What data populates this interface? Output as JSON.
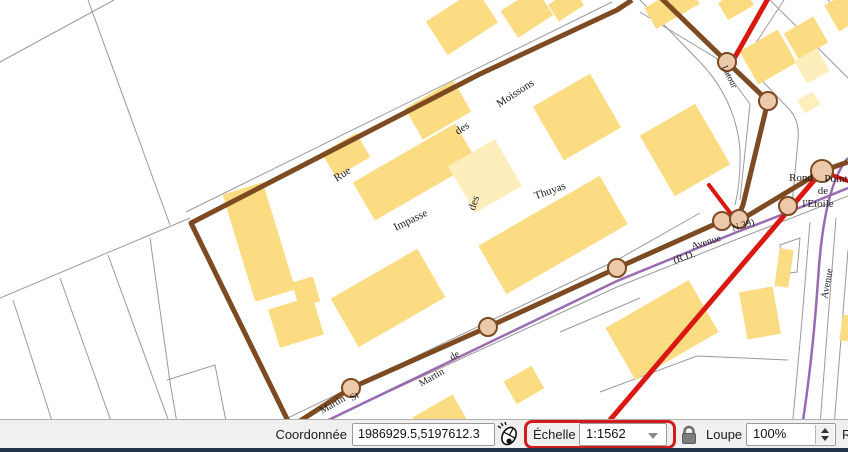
{
  "map": {
    "colors": {
      "background": "#ffffff",
      "building_fill": "#fbdc82",
      "building_light_fill": "#fdeebc",
      "parcel_line": "#9a9a9a",
      "route_brown": "#7d4a22",
      "node_fill": "#ecc9ab",
      "node_stroke": "#7d4a22",
      "road_purple": "#9a6bb0",
      "red_line": "#da1710",
      "label_color": "#1a1a1a"
    },
    "street_labels": [
      "Rue",
      "des",
      "Moissons",
      "Impasse",
      "des",
      "Thuyas",
      "Martin",
      "St",
      "Martin",
      "de",
      "Avenue",
      "(R.D.",
      "N.39)",
      "Avenue",
      "Latour"
    ],
    "place_labels": [
      "Rond",
      "Point",
      "de",
      "l'Etoile"
    ]
  },
  "status_bar": {
    "coordinate": {
      "label": "Coordonnée",
      "value": "1986929.5,5197612.3"
    },
    "scale": {
      "label": "Échelle",
      "value": "1:1562",
      "highlight_color": "#d21c1c"
    },
    "magnifier": {
      "label": "Loupe",
      "value": "100%"
    },
    "clipped_right_label": "R",
    "icons": {
      "mouse_tracking": "mouse-tracking-icon",
      "lock": "lock-icon",
      "combo_arrow": "chevron-down-icon",
      "spinner": "spinner-up-down-icon"
    }
  }
}
